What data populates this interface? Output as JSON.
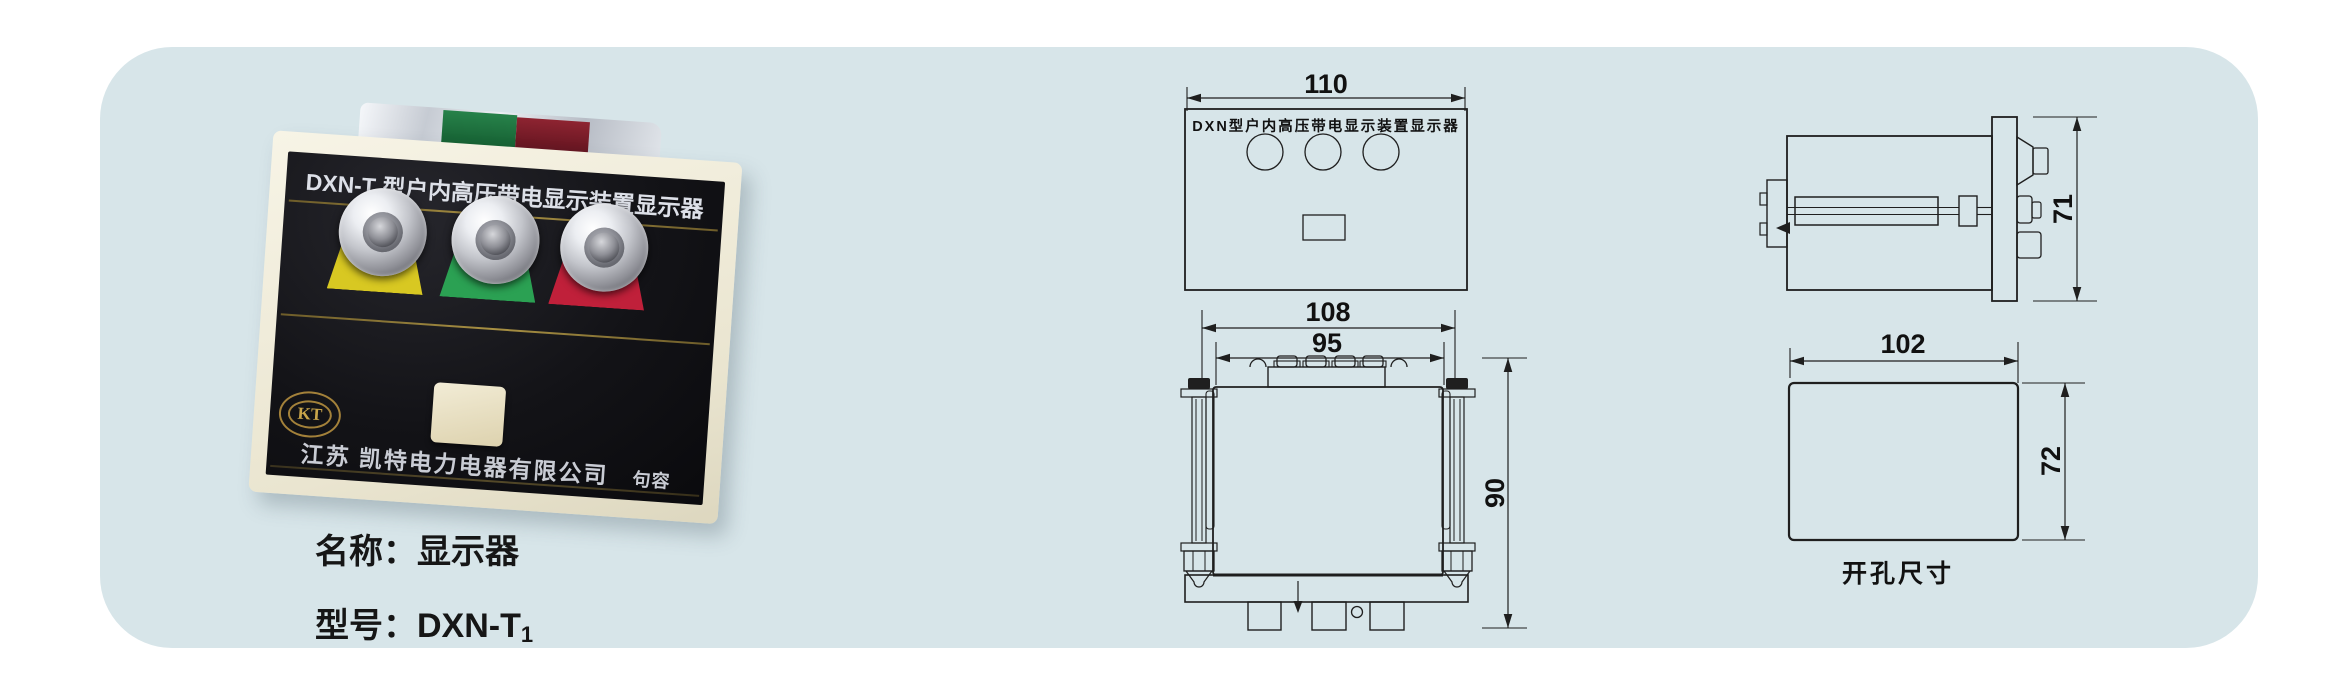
{
  "colors": {
    "page_bg": "#ffffff",
    "panel_bg": "#d7e5e9",
    "lamp_yellow": "#d8c822",
    "lamp_green": "#2ba153",
    "lamp_red": "#c0203a",
    "drawing_line": "#1f1f1f",
    "gold_accent": "#a89043"
  },
  "photo": {
    "device_title": "DXN-T 型户内高压带电显示装置显示器",
    "logo_text": "KT",
    "company_text": "江苏 凯特电力电器有限公司",
    "company_city": "句容"
  },
  "caption": {
    "name_label": "名称：",
    "name_value": "显示器",
    "model_label": "型号：",
    "model_value": "DXN-T",
    "model_subscript": "1"
  },
  "drawings": {
    "front_view": {
      "title": "DXN型户内高压带电显示装置显示器",
      "width": "110"
    },
    "rear_view": {
      "outer_width": "108",
      "inner_width": "95",
      "height": "90"
    },
    "side_view": {
      "height": "71"
    },
    "cutout_view": {
      "width": "102",
      "height": "72",
      "caption": "开孔尺寸"
    }
  }
}
